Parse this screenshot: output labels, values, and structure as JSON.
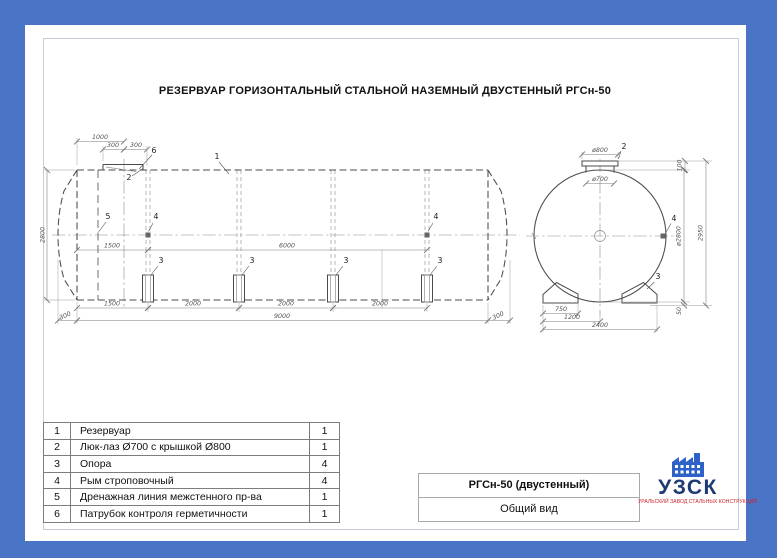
{
  "page": {
    "title": "РЕЗЕРВУАР ГОРИЗОНТАЛЬНЫЙ СТАЛЬНОЙ НАЗЕМНЫЙ ДВУСТЕННЫЙ РГСн-50"
  },
  "colors": {
    "background": "#4a74c6",
    "sheet": "#ffffff",
    "drawing_line": "#4b4b4b",
    "logo_navy": "#1d3a74",
    "logo_icon_blue": "#2e62c9",
    "logo_red": "#cb2026"
  },
  "side_view": {
    "callouts": {
      "c1": "1",
      "c2": "2",
      "c3": "3",
      "c4": "4",
      "c5": "5",
      "c6": "6"
    },
    "dims": {
      "manhole_offset": "1000",
      "manhole_half_a": "300",
      "manhole_half_b": "300",
      "diameter": "2800",
      "inner_left": "1500",
      "inner_span": "6000",
      "support_1": "1500",
      "support_2": "2000",
      "support_3": "2000",
      "support_4": "2000",
      "overhang_left": "300",
      "length_total": "9000",
      "overhang_right": "300"
    }
  },
  "end_view": {
    "callouts": {
      "c2": "2",
      "c3": "3",
      "c4": "4"
    },
    "dims": {
      "cover": "ø800",
      "manhole": "ø700",
      "top_gap": "100",
      "shell": "ø2800",
      "height": "2950",
      "base_gap": "50",
      "foot": "750",
      "half_width": "1200",
      "base_width": "2400"
    }
  },
  "parts_table": {
    "rows": [
      {
        "num": "1",
        "name": "Резервуар",
        "qty": "1"
      },
      {
        "num": "2",
        "name": "Люк-лаз Ø700 с крышкой Ø800",
        "qty": "1"
      },
      {
        "num": "3",
        "name": "Опора",
        "qty": "4"
      },
      {
        "num": "4",
        "name": "Рым строповочный",
        "qty": "4"
      },
      {
        "num": "5",
        "name": "Дренажная линия межстенного пр-ва",
        "qty": "1"
      },
      {
        "num": "6",
        "name": "Патрубок контроля герметичности",
        "qty": "1"
      }
    ]
  },
  "title_block": {
    "model": "РГСн-50 (двустенный)",
    "view_name": "Общий вид"
  },
  "logo": {
    "abbr": "УЗСК",
    "tagline": "УРАЛЬСКИЙ ЗАВОД СТАЛЬНЫХ КОНСТРУКЦИЙ"
  }
}
